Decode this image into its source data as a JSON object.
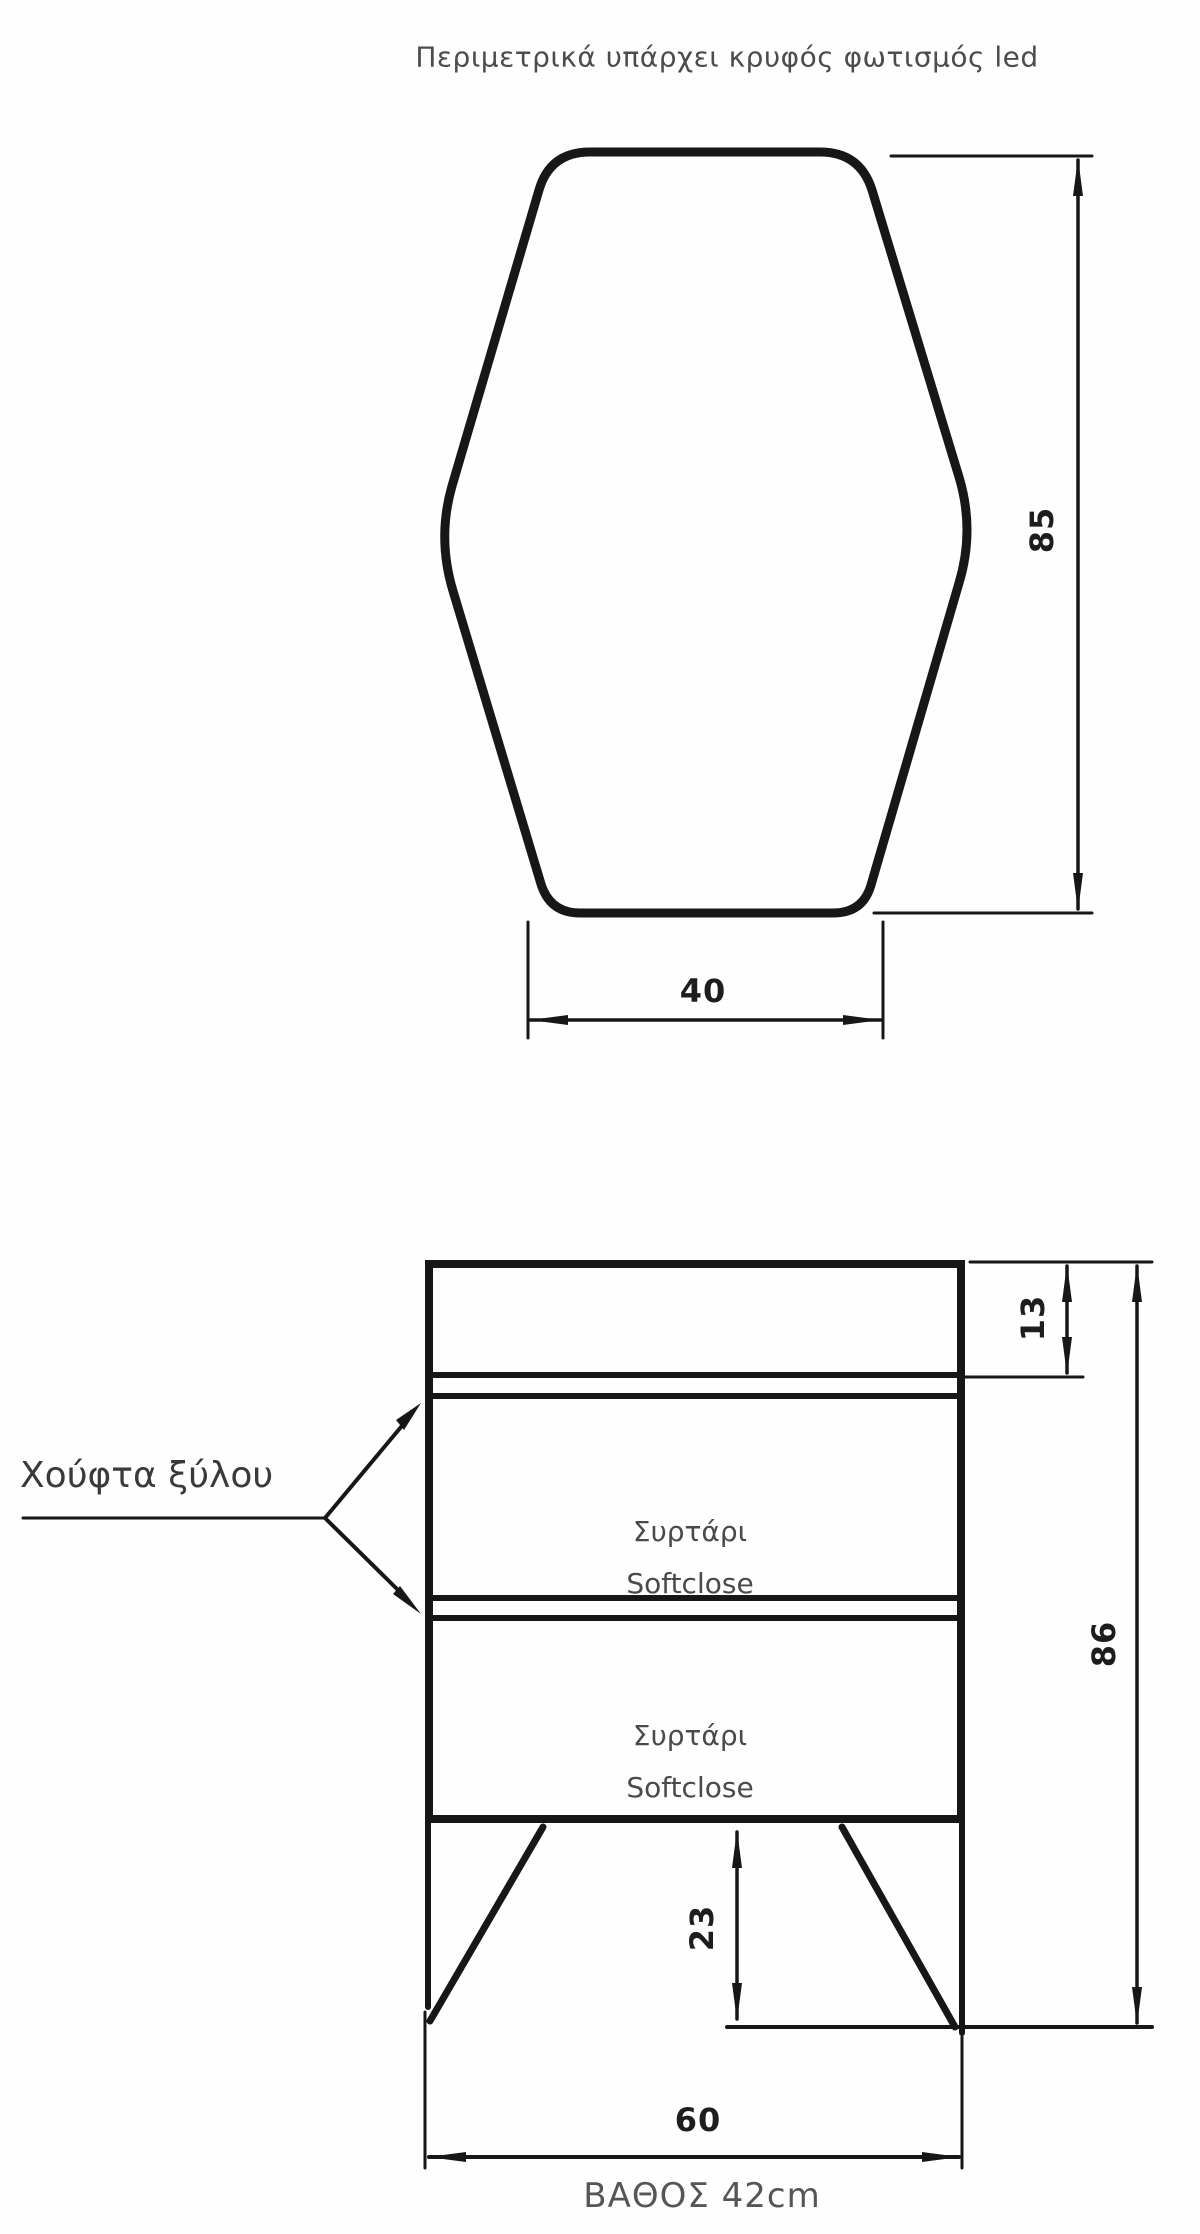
{
  "colors": {
    "line": "#171717",
    "label": "#4a4a4a",
    "dim": "#1d1d1d"
  },
  "mirror_view": {
    "note": "Περιμετρικά υπάρχει κρυφός φωτισμός led",
    "height_dim": "85",
    "width_dim": "40"
  },
  "front_view": {
    "handle_label": "Χούφτα ξύλου",
    "drawers": [
      {
        "line1": "Συρτάρι",
        "line2": "Softclose"
      },
      {
        "line1": "Συρτάρι",
        "line2": "Softclose"
      }
    ],
    "top_height_dim": "13",
    "total_height_dim": "86",
    "leg_height_dim": "23",
    "width_dim": "60",
    "depth_note": "ΒΑΘΟΣ 42cm"
  }
}
